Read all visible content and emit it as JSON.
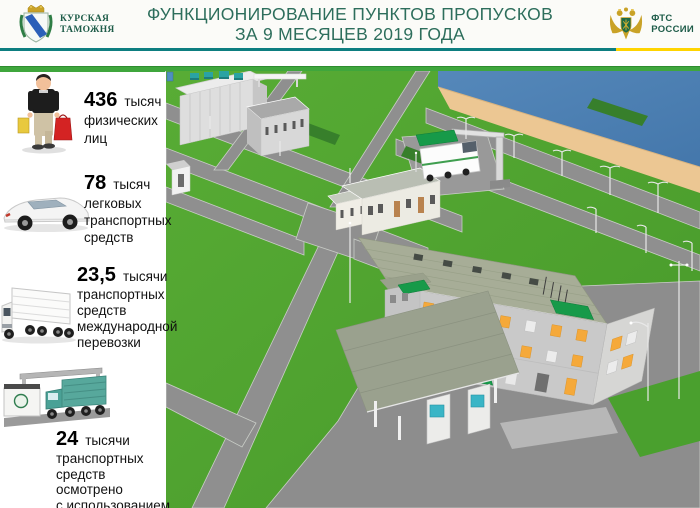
{
  "header": {
    "title_line1": "ФУНКЦИОНИРОВАНИЕ ПУНКТОВ ПРОПУСКОВ",
    "title_line2": "ЗА 9 МЕСЯЦЕВ  2019 ГОДА",
    "left_logo": {
      "line1": "КУРСКАЯ",
      "line2": "ТАМОЖНЯ"
    },
    "right_logo": {
      "line1": "ФТС",
      "line2": "РОССИИ"
    }
  },
  "stats": [
    {
      "icon": "person-with-bags-icon",
      "value": "436",
      "unit": "тысяч",
      "lines": [
        "физических",
        "лиц"
      ]
    },
    {
      "icon": "car-icon",
      "value": "78",
      "unit": "тысяч",
      "lines": [
        "легковых",
        "транспортных",
        "средств"
      ]
    },
    {
      "icon": "cargo-truck-icon",
      "value": "23,5",
      "unit": "тысячи",
      "lines": [
        "транспортных",
        "средств",
        "международной",
        "перевозки"
      ]
    },
    {
      "icon": "scanner-truck-icon",
      "value": "24",
      "unit": "тысячи",
      "lines": [
        "транспортных",
        "средств осмотрено",
        "с использованием",
        "МИДК"
      ]
    }
  ],
  "scene": {
    "type": "3d-illustration",
    "subject": "Вид сверху пункта пропуска: административное здание с навесом и досмотровыми кабинами, склад, МИДК с подъёмной стрелой, подъездные дороги, набережная и река"
  },
  "palette": {
    "teal_line": "#0d7e80",
    "yellow_line": "#ffd400",
    "green_bar": "#3fa63c",
    "title_green": "#2d6e5c",
    "logo_green": "#1e5c49",
    "text_black": "#111111",
    "grass": "#52a631",
    "grass_dark": "#47992a",
    "hedge": "#377f2b",
    "road": "#8f8f8f",
    "road_edge": "#c9cdc7",
    "water": "#4c80b4",
    "sand": "#ecc793",
    "roof": "#a7ad97",
    "wall_light": "#c9c9c9",
    "window_orange": "#f5a93a",
    "awning": "#179a49",
    "booth_teal": "#3ab5c6",
    "vent_teal": "#2aa3a3"
  }
}
